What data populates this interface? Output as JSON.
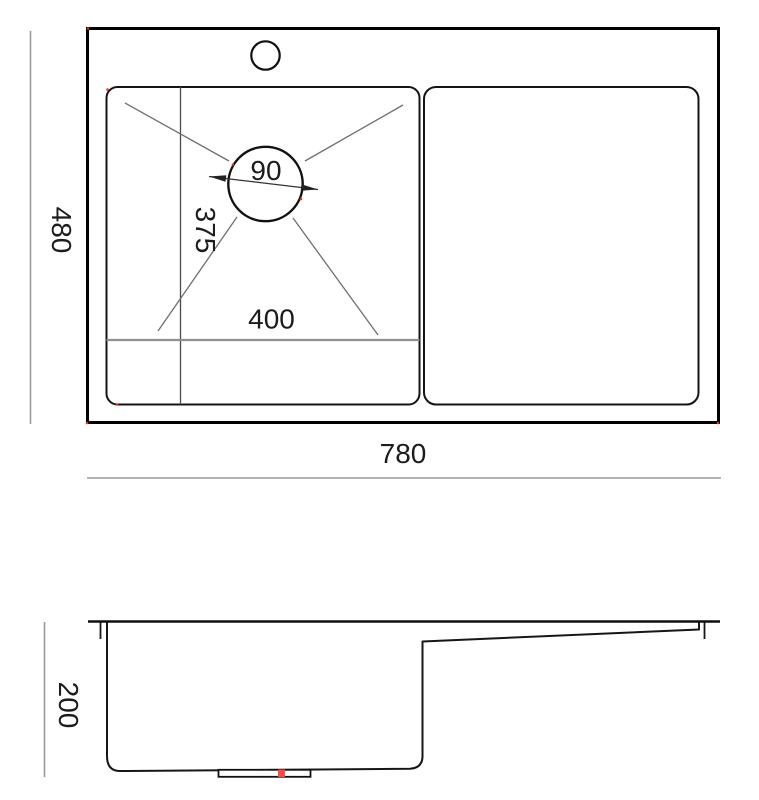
{
  "drawing": {
    "dimension_labels": {
      "overall_width": "780",
      "overall_depth": "480",
      "bowl_width": "400",
      "bowl_depth": "375",
      "drain_diameter": "90",
      "bowl_height": "200"
    },
    "colors": {
      "outline": "#000000",
      "inner_outline": "#141414",
      "dimension_line": "#9a9a9a",
      "leader_line": "#6f6f6f",
      "text": "#1c1c1e",
      "marker_red": "#fb4b49",
      "background": "#ffffff"
    }
  }
}
